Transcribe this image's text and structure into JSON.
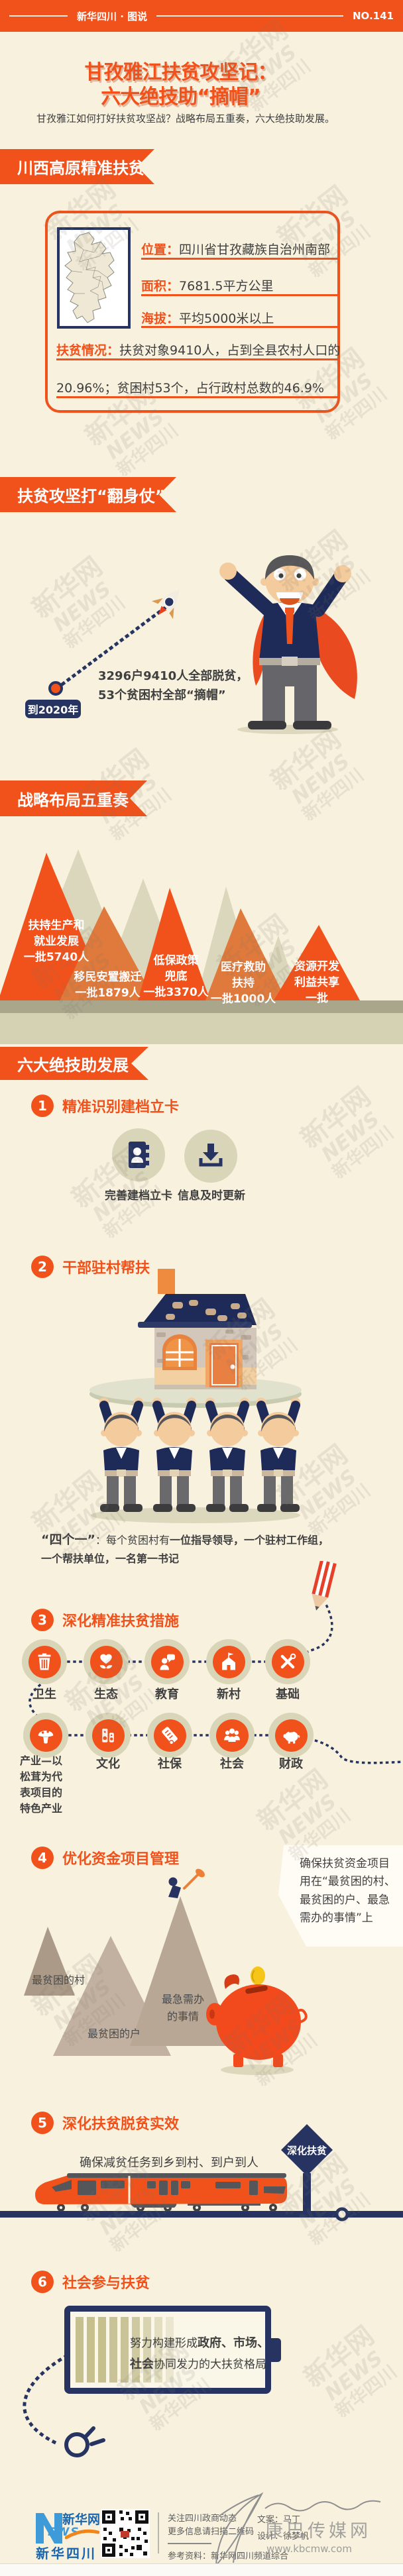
{
  "page": {
    "masthead": "新华四川 · 图说",
    "issue_no": "NO.141"
  },
  "title": {
    "line1": "甘孜雅江扶贫攻坚记：",
    "line2": "六大绝技助“摘帽”",
    "subtitle": "甘孜雅江如何打好扶贫攻坚战？战略布局五重奏，六大绝技助发展。"
  },
  "watermark": {
    "line1": "新华网",
    "line2": "NEWS",
    "line3": "新华四川"
  },
  "section1": {
    "banner": "川西高原精准扶贫",
    "location_label": "位置：",
    "location_value": "四川省甘孜藏族自治州南部",
    "area_label": "面积：",
    "area_value": "7681.5平方公里",
    "altitude_label": "海拔：",
    "altitude_value": "平均5000米以上",
    "poverty_label": "扶贫情况：",
    "poverty_value_1": "扶贫对象9410人，占到全县农村人口的",
    "poverty_value_2": "20.96%；贫困村53个，占行政村总数的46.9%"
  },
  "section2": {
    "banner": "扶贫攻坚打“翻身仗”",
    "year_badge": "到2020年",
    "goal_line1": "3296户9410人全部脱贫，",
    "goal_line2": "53个贫困村全部“摘帽”"
  },
  "section3": {
    "banner": "战略布局五重奏",
    "mountains": [
      {
        "lines": [
          "扶持生产和",
          "就业发展",
          "一批5740人"
        ]
      },
      {
        "lines": [
          "移民安置搬迁",
          "一批1879人"
        ]
      },
      {
        "lines": [
          "低保政策",
          "兜底",
          "一批3370人"
        ]
      },
      {
        "lines": [
          "医疗救助",
          "扶持",
          "一批1000人"
        ]
      },
      {
        "lines": [
          "资源开发",
          "利益共享",
          "一批"
        ]
      }
    ]
  },
  "section4": {
    "banner": "六大绝技助发展"
  },
  "item1": {
    "num": "1",
    "title": "精准识别建档立卡",
    "icon1": "contact-card-icon",
    "label1": "完善建档立卡",
    "icon2": "download-icon",
    "label2": "信息及时更新"
  },
  "item2": {
    "num": "2",
    "title": "干部驻村帮扶",
    "quote": "“四个一”",
    "t1": "：每个贫困村有",
    "b1": "一位指导领导",
    "t2": "，",
    "b2": "一个驻村工作组",
    "t3": "，",
    "b3": "一个帮扶单位",
    "t4": "，",
    "b4": "一名第一书记"
  },
  "item3": {
    "num": "3",
    "title": "深化精准扶贫措施",
    "row1": [
      {
        "icon": "trash-icon",
        "label": "卫生"
      },
      {
        "icon": "eco-flower-icon",
        "label": "生态"
      },
      {
        "icon": "teacher-icon",
        "label": "教育"
      },
      {
        "icon": "house-flag-icon",
        "label": "新村"
      },
      {
        "icon": "tools-icon",
        "label": "基础"
      }
    ],
    "row2": [
      {
        "icon": "mushroom-icon",
        "label_lines": [
          "产业—以",
          "松茸为代",
          "表项目的",
          "特色产业"
        ]
      },
      {
        "icon": "speakers-icon",
        "label": "文化"
      },
      {
        "icon": "scroll-icon",
        "label": "社保"
      },
      {
        "icon": "people-icon",
        "label": "社会"
      },
      {
        "icon": "piggy-icon",
        "label": "财政"
      }
    ]
  },
  "item4": {
    "num": "4",
    "title": "优化资金项目管理",
    "note_lines": [
      "确保扶贫资金项目",
      "用在“最贫困的村、",
      "最贫困的户、最急",
      "需办的事情”上"
    ],
    "label_village": "最贫困的村",
    "label_household": "最贫困的户",
    "label_matter1": "最急需办",
    "label_matter2": "的事情"
  },
  "item5": {
    "num": "5",
    "title": "深化扶贫脱贫实效",
    "desc": "确保减贫任务到乡到村、到户到人",
    "sign": "深化扶贫"
  },
  "item6": {
    "num": "6",
    "title": "社会参与扶贫",
    "t1": "努力构建形成",
    "b1": "政府、市场、",
    "b2": "社会",
    "t2": "协同发力的大扶贫格局"
  },
  "footer": {
    "brand_line1": "新华网",
    "brand_news": "EWS",
    "brand_line2": "新华四川",
    "follow1": "关注四川政商动态",
    "follow2": "更多信息请扫描二维码",
    "reference": "参考资料：新华网四川频道综合",
    "credit_writer": "文案：马丁",
    "credit_designer": "设计：徐梦帆",
    "stamp_name": "康巴传媒网",
    "stamp_url": "www.kbcmw.com"
  },
  "colors": {
    "accent": "#f1521c",
    "navy": "#273461",
    "cream": "#f7f1de",
    "sage": "#d9d5b8",
    "burnt": "#df7a3c"
  }
}
